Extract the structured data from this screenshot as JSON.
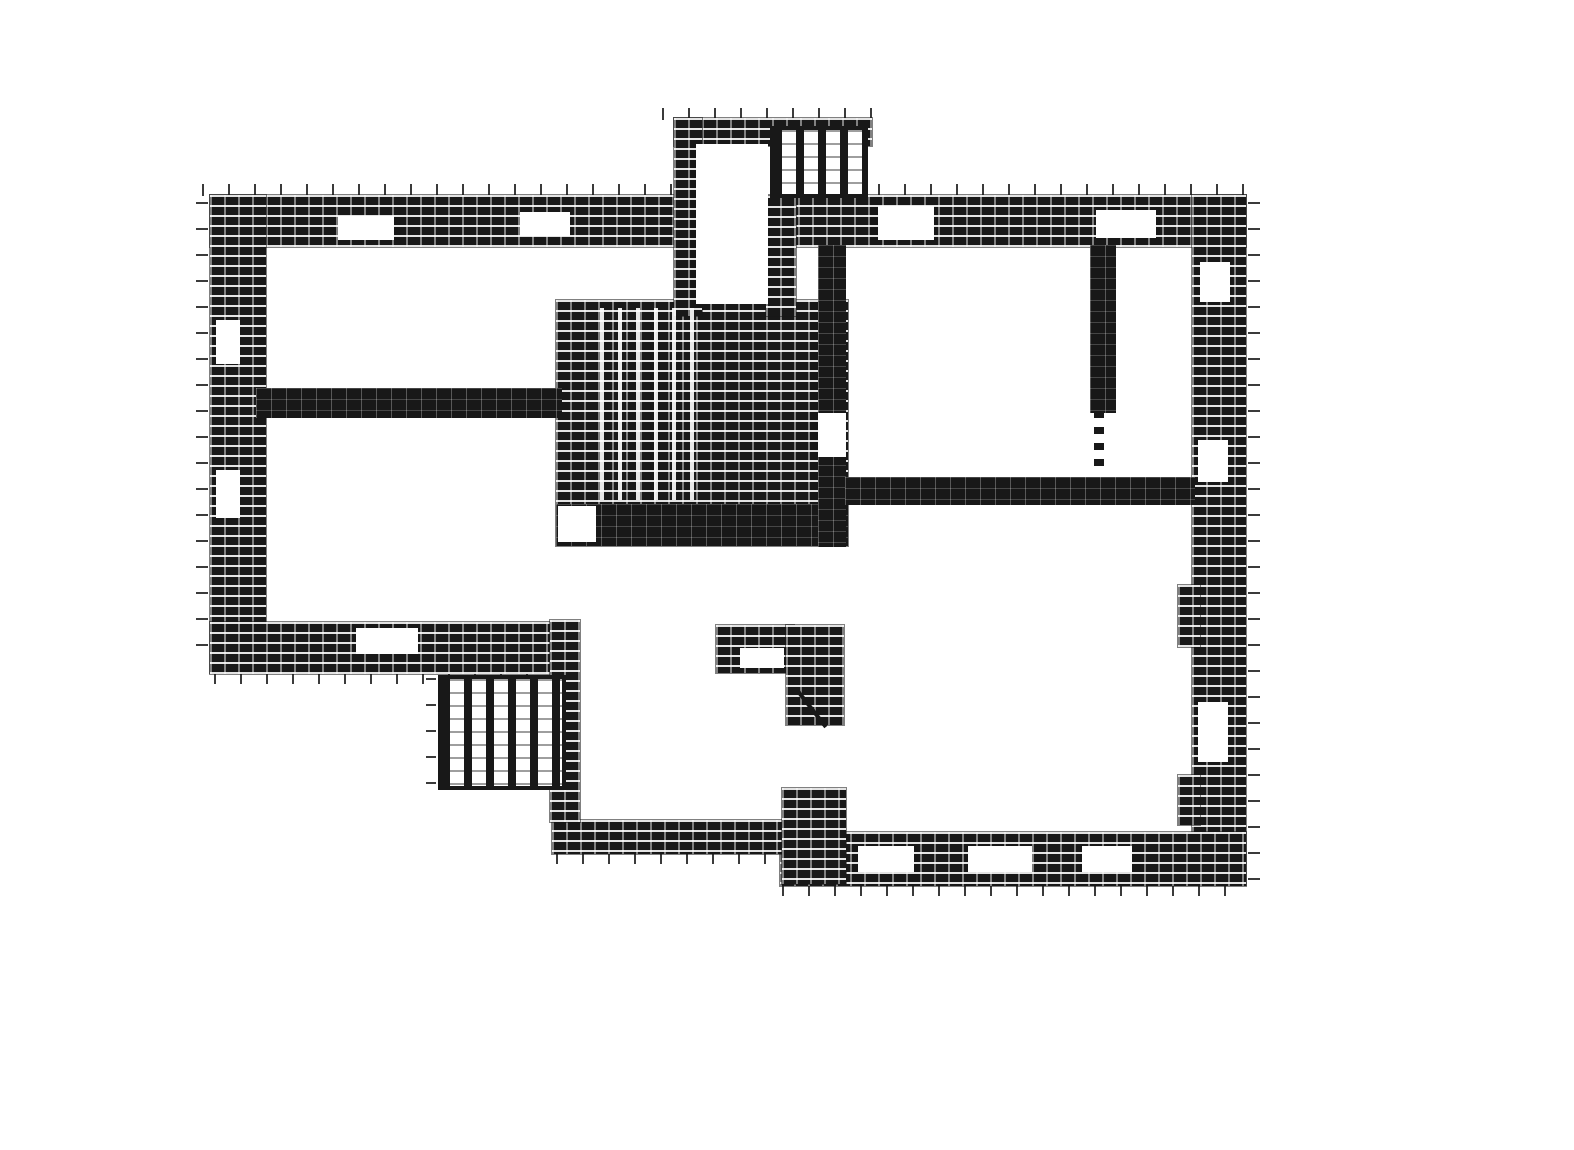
{
  "canvas": {
    "width": 1574,
    "height": 1150
  },
  "palette": {
    "paper": "#ffffff",
    "ink": "#181818"
  },
  "plan": {
    "kind_legend": {
      "wall-hatch": "hatched masonry wall",
      "wall-solid": "solid interior wall",
      "stair-vertical": "stair with vertical treads",
      "stair-treads": "stair treads overlay on core",
      "white": "opening / window / shaft void",
      "door-dash-v": "dashed door opening",
      "door-line": "door swing stroke",
      "tick-h": "hatch overshoot ticks (horizontal strip)",
      "tick-v": "hatch overshoot ticks (vertical strip)"
    },
    "elements": [
      {
        "name": "ticks-top-outer",
        "kind": "tick-h",
        "x": 202,
        "y": 184,
        "w": 1050,
        "h": 12
      },
      {
        "name": "ticks-projection-top",
        "kind": "tick-h",
        "x": 662,
        "y": 108,
        "w": 218,
        "h": 12
      },
      {
        "name": "ticks-left-outer",
        "kind": "tick-v",
        "x": 196,
        "y": 202,
        "w": 12,
        "h": 466
      },
      {
        "name": "ticks-east-outer",
        "kind": "tick-v",
        "x": 1248,
        "y": 202,
        "w": 12,
        "h": 680
      },
      {
        "name": "ticks-bottom-left",
        "kind": "tick-h",
        "x": 214,
        "y": 674,
        "w": 344,
        "h": 10
      },
      {
        "name": "ticks-bottom-mid",
        "kind": "tick-h",
        "x": 556,
        "y": 854,
        "w": 242,
        "h": 10
      },
      {
        "name": "ticks-bottom-right",
        "kind": "tick-h",
        "x": 782,
        "y": 886,
        "w": 464,
        "h": 10
      },
      {
        "name": "ticks-stair-left",
        "kind": "tick-v",
        "x": 426,
        "y": 678,
        "w": 10,
        "h": 112
      },
      {
        "name": "wall-top",
        "kind": "wall-hatch",
        "x": 210,
        "y": 195,
        "w": 1036,
        "h": 52
      },
      {
        "name": "wall-left",
        "kind": "wall-hatch",
        "x": 210,
        "y": 195,
        "w": 56,
        "h": 478
      },
      {
        "name": "wall-east",
        "kind": "wall-hatch",
        "x": 1192,
        "y": 195,
        "w": 54,
        "h": 690
      },
      {
        "name": "wall-bottom-left",
        "kind": "wall-hatch",
        "x": 210,
        "y": 622,
        "w": 352,
        "h": 52
      },
      {
        "name": "wall-bottom-right",
        "kind": "wall-hatch",
        "x": 780,
        "y": 832,
        "w": 466,
        "h": 54
      },
      {
        "name": "wall-bottom-mid",
        "kind": "wall-hatch",
        "x": 552,
        "y": 820,
        "w": 250,
        "h": 34
      },
      {
        "name": "wall-mid-left-vertical",
        "kind": "wall-hatch",
        "x": 550,
        "y": 620,
        "w": 30,
        "h": 202
      },
      {
        "name": "stair-core-block",
        "kind": "wall-hatch",
        "x": 556,
        "y": 300,
        "w": 292,
        "h": 246
      },
      {
        "name": "wall-core-bottom",
        "kind": "wall-solid",
        "x": 556,
        "y": 504,
        "w": 292,
        "h": 42
      },
      {
        "name": "wall-projection-top",
        "kind": "wall-hatch",
        "x": 674,
        "y": 118,
        "w": 198,
        "h": 28
      },
      {
        "name": "wall-projection-left",
        "kind": "wall-hatch",
        "x": 674,
        "y": 118,
        "w": 28,
        "h": 198
      },
      {
        "name": "wall-shaft-right",
        "kind": "wall-hatch",
        "x": 766,
        "y": 196,
        "w": 30,
        "h": 120
      },
      {
        "name": "wall-room-divider",
        "kind": "wall-solid",
        "x": 818,
        "y": 245,
        "w": 28,
        "h": 302
      },
      {
        "name": "wall-rooms-bottom",
        "kind": "wall-solid",
        "x": 845,
        "y": 477,
        "w": 350,
        "h": 28
      },
      {
        "name": "wall-narrow-room-left",
        "kind": "wall-solid",
        "x": 1090,
        "y": 245,
        "w": 26,
        "h": 168
      },
      {
        "name": "wall-interior-left",
        "kind": "wall-solid",
        "x": 256,
        "y": 388,
        "w": 306,
        "h": 30
      },
      {
        "name": "wall-closet-top",
        "kind": "wall-hatch",
        "x": 716,
        "y": 625,
        "w": 78,
        "h": 48
      },
      {
        "name": "wall-closet-right",
        "kind": "wall-hatch",
        "x": 786,
        "y": 625,
        "w": 58,
        "h": 100
      },
      {
        "name": "wall-junction-block",
        "kind": "wall-hatch",
        "x": 782,
        "y": 788,
        "w": 64,
        "h": 96
      },
      {
        "name": "wall-east-pier-upper",
        "kind": "wall-hatch",
        "x": 1178,
        "y": 585,
        "w": 22,
        "h": 62
      },
      {
        "name": "wall-east-pier-lower",
        "kind": "wall-hatch",
        "x": 1178,
        "y": 775,
        "w": 22,
        "h": 50
      },
      {
        "name": "roof-ladder-stair",
        "kind": "stair-vertical",
        "x": 770,
        "y": 126,
        "w": 98,
        "h": 72
      },
      {
        "name": "exterior-stair",
        "kind": "stair-vertical",
        "x": 438,
        "y": 675,
        "w": 128,
        "h": 115
      },
      {
        "name": "core-stair-treads",
        "kind": "stair-treads",
        "x": 600,
        "y": 308,
        "w": 104,
        "h": 192
      },
      {
        "name": "shaft-opening",
        "kind": "white",
        "x": 696,
        "y": 144,
        "w": 72,
        "h": 160
      },
      {
        "name": "core-landing",
        "kind": "white",
        "x": 558,
        "y": 506,
        "w": 38,
        "h": 36
      },
      {
        "name": "door-room-divider",
        "kind": "white",
        "x": 818,
        "y": 413,
        "w": 28,
        "h": 44
      },
      {
        "name": "gap-above-divider",
        "kind": "white",
        "x": 798,
        "y": 250,
        "w": 18,
        "h": 48
      },
      {
        "name": "window-top-1",
        "kind": "white",
        "x": 338,
        "y": 216,
        "w": 56,
        "h": 24
      },
      {
        "name": "window-top-2",
        "kind": "white",
        "x": 520,
        "y": 212,
        "w": 50,
        "h": 24
      },
      {
        "name": "window-top-3",
        "kind": "white",
        "x": 878,
        "y": 206,
        "w": 56,
        "h": 34
      },
      {
        "name": "window-top-4",
        "kind": "white",
        "x": 1096,
        "y": 210,
        "w": 60,
        "h": 28
      },
      {
        "name": "window-bottom-left",
        "kind": "white",
        "x": 356,
        "y": 628,
        "w": 62,
        "h": 26
      },
      {
        "name": "window-bottom-right-1",
        "kind": "white",
        "x": 858,
        "y": 846,
        "w": 56,
        "h": 26
      },
      {
        "name": "window-bottom-right-2",
        "kind": "white",
        "x": 968,
        "y": 846,
        "w": 64,
        "h": 26
      },
      {
        "name": "window-bottom-right-3",
        "kind": "white",
        "x": 1082,
        "y": 846,
        "w": 50,
        "h": 26
      },
      {
        "name": "window-left-1",
        "kind": "white",
        "x": 216,
        "y": 320,
        "w": 24,
        "h": 44
      },
      {
        "name": "window-left-2",
        "kind": "white",
        "x": 216,
        "y": 470,
        "w": 24,
        "h": 48
      },
      {
        "name": "window-east-1",
        "kind": "white",
        "x": 1200,
        "y": 262,
        "w": 30,
        "h": 40
      },
      {
        "name": "window-east-2",
        "kind": "white",
        "x": 1198,
        "y": 440,
        "w": 30,
        "h": 42
      },
      {
        "name": "window-east-3",
        "kind": "white",
        "x": 1198,
        "y": 702,
        "w": 30,
        "h": 60
      },
      {
        "name": "window-closet",
        "kind": "white",
        "x": 740,
        "y": 648,
        "w": 44,
        "h": 20
      },
      {
        "name": "door-narrow-room-dashed",
        "kind": "door-dash-v",
        "x": 1094,
        "y": 411,
        "w": 10,
        "h": 64
      },
      {
        "name": "door-swing-closet",
        "kind": "door-line",
        "x": 796,
        "y": 692,
        "w": 4,
        "h": 46,
        "rotate": -38
      }
    ]
  }
}
